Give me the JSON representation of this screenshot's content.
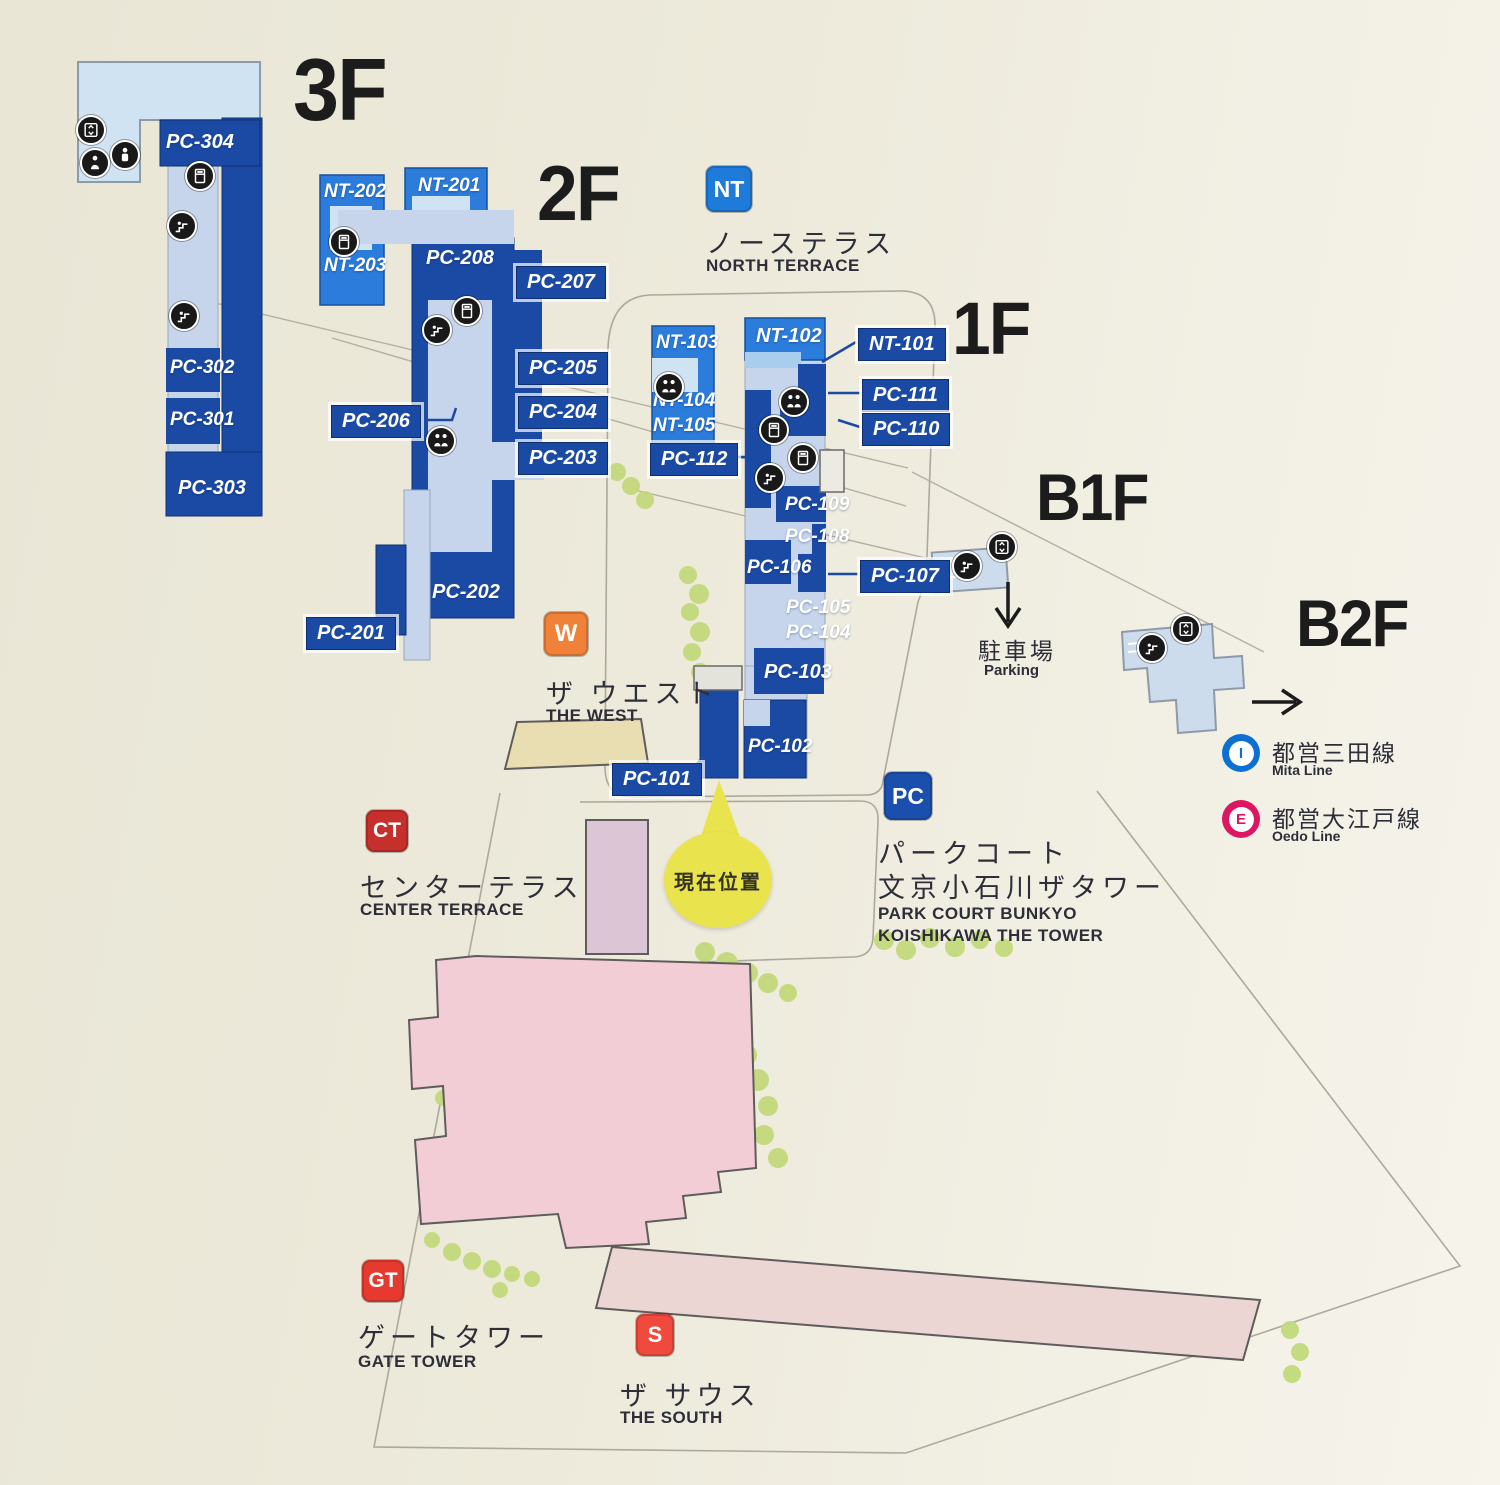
{
  "floors": {
    "f3": "3F",
    "f2": "2F",
    "f1": "1F",
    "b1": "B1F",
    "b2": "B2F"
  },
  "units": {
    "pc301": "PC-301",
    "pc302": "PC-302",
    "pc303": "PC-303",
    "pc304": "PC-304",
    "nt201": "NT-201",
    "nt202": "NT-202",
    "nt203": "NT-203",
    "pc201": "PC-201",
    "pc202": "PC-202",
    "pc203": "PC-203",
    "pc204": "PC-204",
    "pc205": "PC-205",
    "pc206": "PC-206",
    "pc207": "PC-207",
    "pc208": "PC-208",
    "nt101": "NT-101",
    "nt102": "NT-102",
    "nt103": "NT-103",
    "nt104": "NT-104",
    "nt105": "NT-105",
    "pc101": "PC-101",
    "pc102": "PC-102",
    "pc103": "PC-103",
    "pc104": "PC-104",
    "pc105": "PC-105",
    "pc106": "PC-106",
    "pc107": "PC-107",
    "pc108": "PC-108",
    "pc109": "PC-109",
    "pc110": "PC-110",
    "pc111": "PC-111",
    "pc112": "PC-112"
  },
  "legends": {
    "nt": {
      "badge": "NT",
      "jp": "ノーステラス",
      "en": "NORTH TERRACE"
    },
    "w": {
      "badge": "W",
      "jp": "ザ ウエスト",
      "en": "THE WEST"
    },
    "ct": {
      "badge": "CT",
      "jp": "センターテラス",
      "en": "CENTER TERRACE"
    },
    "pc": {
      "badge": "PC",
      "jp_line1": "パークコート",
      "jp_line2": "文京小石川ザタワー",
      "en_line1": "PARK COURT BUNKYO",
      "en_line2": "KOISHIKAWA THE TOWER"
    },
    "gt": {
      "badge": "GT",
      "jp": "ゲートタワー",
      "en": "GATE TOWER"
    },
    "s": {
      "badge": "S",
      "jp": "ザ サウス",
      "en": "THE SOUTH"
    }
  },
  "parking": {
    "jp": "駐車場",
    "en": "Parking"
  },
  "transit": {
    "mita": {
      "symbol": "I",
      "jp": "都営三田線",
      "en": "Mita Line",
      "color": "#0d6fd1"
    },
    "oedo": {
      "symbol": "E",
      "jp": "都営大江戸線",
      "en": "Oedo Line",
      "color": "#dc1660"
    }
  },
  "current_position": "現在位置",
  "colors": {
    "building_dark_blue": "#1b4aa4",
    "building_bright_blue": "#2b7cdb",
    "corridor_pale_blue": "#c6d5ec",
    "floor_light_blue": "#cfe3f3",
    "basement_blue": "#ccdcec",
    "badge_nt": "#1e7bd9",
    "badge_pc": "#1b4fae",
    "badge_w": "#ef8238",
    "badge_ct": "#c5302c",
    "badge_gt": "#e63a2e",
    "badge_s": "#f04a3c",
    "highlight_yellow": "#e9e34d",
    "bldg_pink": "#f3cdd5",
    "bldg_pink_light": "#ecd6d4",
    "bldg_mauve": "#dcc6d6",
    "bldg_tan": "#e9ddb2",
    "tree_green": "#c3da7c",
    "background": "#edeadc"
  }
}
